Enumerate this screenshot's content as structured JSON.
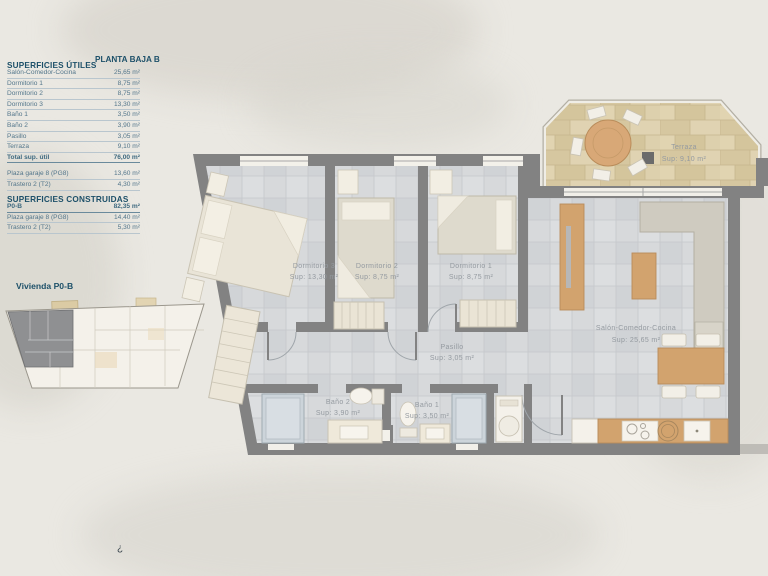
{
  "tables": {
    "utiles": {
      "title": "SUPERFICIES ÚTILES",
      "subtitle": "PLANTA BAJA B",
      "rows": [
        {
          "label": "Salón-Comedor-Cocina",
          "value": "25,65 m²"
        },
        {
          "label": "Dormitorio 1",
          "value": "8,75 m²"
        },
        {
          "label": "Dormitorio 2",
          "value": "8,75 m²"
        },
        {
          "label": "Dormitorio 3",
          "value": "13,30 m²"
        },
        {
          "label": "Baño 1",
          "value": "3,50 m²"
        },
        {
          "label": "Baño 2",
          "value": "3,90 m²"
        },
        {
          "label": "Pasillo",
          "value": "3,05 m²"
        },
        {
          "label": "Terraza",
          "value": "9,10 m²"
        }
      ],
      "total": {
        "label": "Total sup. útil",
        "value": "76,00 m²"
      },
      "annex_rows": [
        {
          "label": "Plaza garaje 8 (PG8)",
          "value": "13,60 m²"
        },
        {
          "label": "Trastero 2 (T2)",
          "value": "4,30 m²"
        }
      ]
    },
    "construidas": {
      "title": "SUPERFICIES CONSTRUIDAS",
      "main_row": {
        "label": "P0-B",
        "value": "82,35 m²"
      },
      "rows": [
        {
          "label": "Plaza garaje 8 (PG8)",
          "value": "14,40 m²"
        },
        {
          "label": "Trastero 2 (T2)",
          "value": "5,30 m²"
        }
      ]
    }
  },
  "overview": {
    "caption": "Vivienda P0-B"
  },
  "plan": {
    "rooms": [
      {
        "id": "dormitorio-3",
        "name": "Dormitorio 3",
        "sup": "Sup: 13,30 m²"
      },
      {
        "id": "dormitorio-2",
        "name": "Dormitorio 2",
        "sup": "Sup: 8,75 m²"
      },
      {
        "id": "dormitorio-1",
        "name": "Dormitorio 1",
        "sup": "Sup: 8,75 m²"
      },
      {
        "id": "terraza",
        "name": "Terraza",
        "sup": "Sup: 9,10 m²"
      },
      {
        "id": "salon",
        "name": "Salón-Comedor-Cocina",
        "sup": "Sup: 25,65 m²"
      },
      {
        "id": "pasillo",
        "name": "Pasillo",
        "sup": "Sup: 3,05 m²"
      },
      {
        "id": "bano-2",
        "name": "Baño 2",
        "sup": "Sup: 3,90 m²"
      },
      {
        "id": "bano-1",
        "name": "Baño 1",
        "sup": "Sup: 3,50 m²"
      }
    ]
  },
  "footer": {
    "mark": "¿"
  },
  "colors": {
    "accent_navy": "#1d5069",
    "row_text": "#53768b",
    "wall_gray": "#828282",
    "floor_gray": "#d7d9db",
    "floor_tan": "#dccfab",
    "wood": "#d2a36e"
  }
}
